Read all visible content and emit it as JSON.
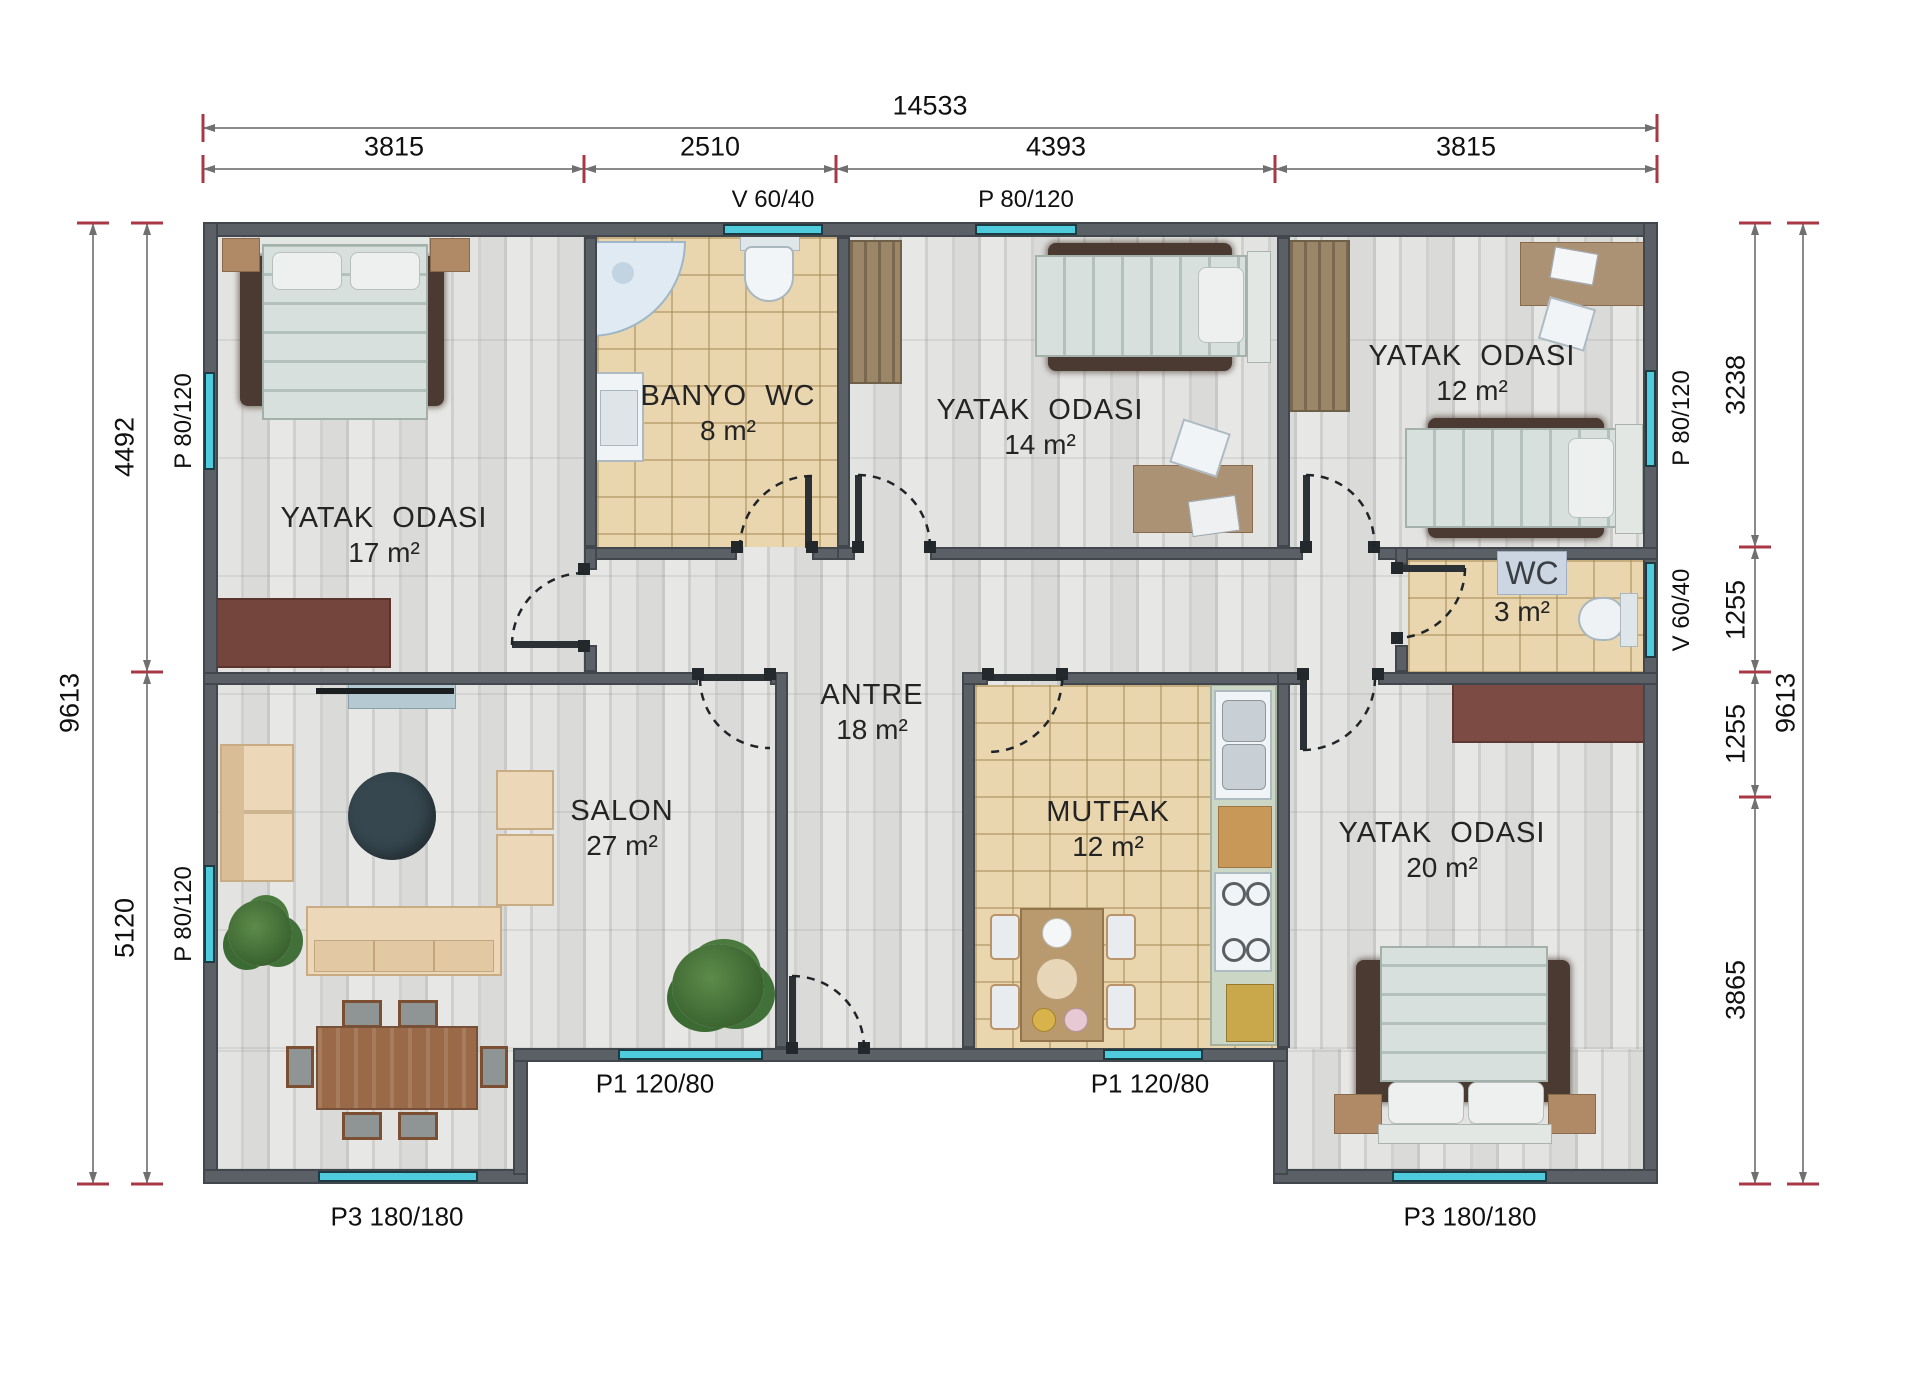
{
  "title": "Prefabrik ev kat plani",
  "plan": {
    "rooms": [
      {
        "id": "bedroom-17",
        "name": "YATAK ODASI",
        "area": "17 m²"
      },
      {
        "id": "bathroom",
        "name": "BANYO WC",
        "area": "8 m²"
      },
      {
        "id": "bedroom-14",
        "name": "YATAK ODASI",
        "area": "14 m²"
      },
      {
        "id": "bedroom-12",
        "name": "YATAK ODASI",
        "area": "12 m²"
      },
      {
        "id": "wc",
        "name": "WC",
        "area": "3 m²"
      },
      {
        "id": "hall",
        "name": "ANTRE",
        "area": "18  m²"
      },
      {
        "id": "living-room",
        "name": "SALON",
        "area": "27 m²"
      },
      {
        "id": "kitchen",
        "name": "MUTFAK",
        "area": "12  m²"
      },
      {
        "id": "bedroom-20",
        "name": "YATAK ODASI",
        "area": "20 m²"
      }
    ]
  },
  "dimensions": {
    "top": {
      "total": "14533",
      "segments": [
        "3815",
        "2510",
        "4393",
        "3815"
      ]
    },
    "left": {
      "total": "9613",
      "segments": [
        "4492",
        "5120"
      ]
    },
    "right": {
      "total": "9613",
      "segments": [
        "3238",
        "1255",
        "1255",
        "3865"
      ]
    }
  },
  "openings": {
    "top": [
      "V 60/40",
      "P 80/120"
    ],
    "left": [
      "P 80/120",
      "P 80/120"
    ],
    "right": [
      "P 80/120",
      "V 60/40"
    ],
    "entry": [
      "P1 120/80",
      "P1 120/80"
    ],
    "bottom": [
      "P3 180/180",
      "P3 180/180"
    ]
  },
  "colors": {
    "window_cyan": "#4ecbdc",
    "wall_gray": "#5a6066",
    "tile_floor": "#e9d6ae",
    "wood_floor": "#d9d9d7",
    "dim_tick_red": "#a83845",
    "rug_brown": "#4a3a31",
    "sofa_beige": "#ecd7b8"
  }
}
